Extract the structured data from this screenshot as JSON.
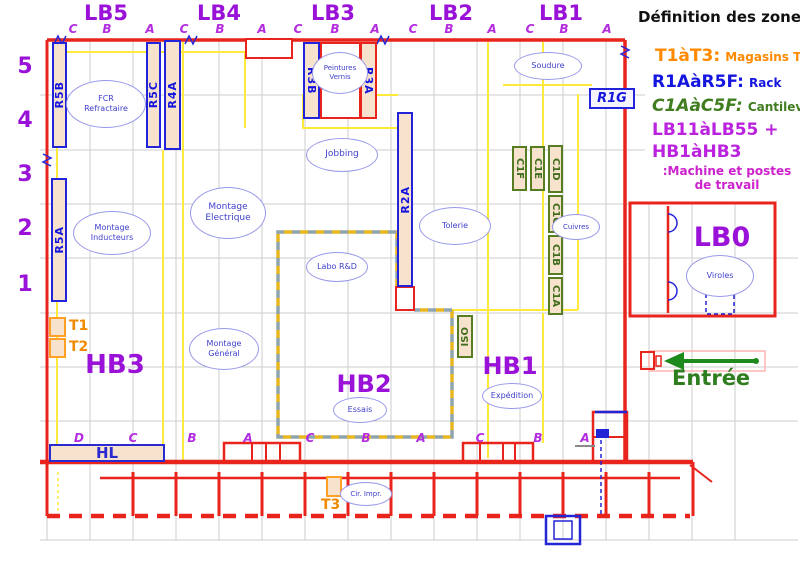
{
  "colors": {
    "wall_red": "#e8241c",
    "zone_purple": "#9a12d8",
    "rack_blue": "#1414dd",
    "cantilever_green": "#3f6d1c",
    "tour_orange": "#ff8a00",
    "machine_magenta": "#cc22cc",
    "entry_green": "#2e7d1e",
    "aisle_yellow": "#ffe93a",
    "rack_fill": "#f7e2cd",
    "cloud_blue": "#9898ea",
    "grid_gray": "#cdcdcd"
  },
  "top_zones": [
    {
      "label": "LB5",
      "letters": [
        "C",
        "B",
        "A"
      ]
    },
    {
      "label": "LB4",
      "letters": [
        "C",
        "B",
        "A"
      ]
    },
    {
      "label": "LB3",
      "letters": [
        "C",
        "B",
        "A"
      ]
    },
    {
      "label": "LB2",
      "letters": [
        "C",
        "B",
        "A"
      ]
    },
    {
      "label": "LB1",
      "letters": [
        "C",
        "B",
        "A"
      ]
    }
  ],
  "row_numbers": [
    "5",
    "4",
    "3",
    "2",
    "1"
  ],
  "bottom_letters": [
    "D",
    "C",
    "B",
    "A",
    "C",
    "B",
    "A",
    "C",
    "B",
    "A"
  ],
  "halls": {
    "hb3": "HB3",
    "hb2": "HB2",
    "hb1": "HB1",
    "lb0": "LB0",
    "hl": "HL"
  },
  "racks": {
    "r5b": "R5B",
    "r5c": "R5C",
    "r4a": "R4A",
    "r5a": "R5A",
    "r3b": "R3B",
    "r3a": "R3A",
    "r2a": "R2A",
    "r1g": "R1G"
  },
  "cantilevers": {
    "c1f": "C1F",
    "c1e": "C1E",
    "c1d": "C1D",
    "c1c": "C1C",
    "c1b": "C1B",
    "c1a": "C1A"
  },
  "iso_label": "ISO",
  "tours": {
    "t1": "T1",
    "t2": "T2",
    "t3": "T3"
  },
  "areas": {
    "fcr": "FCR\nRefractaire",
    "peintures": "Peintures\nVernis",
    "soudure": "Soudure",
    "jobbing": "Jobbing",
    "montage_electrique": "Montage\nElectrique",
    "montage_inducteurs": "Montage\nInducteurs",
    "tolerie": "Tolerie",
    "cuivres": "Cuivres",
    "labo_rd": "Labo R&D",
    "montage_general": "Montage\nGénéral",
    "essais": "Essais",
    "expedition": "Expédition",
    "viroles": "Viroles",
    "cir_impr": "Cir. Impr."
  },
  "legend": {
    "title": "Définition des zones:",
    "entries": [
      {
        "term": "T1àT3:",
        "desc": "Magasins Tour"
      },
      {
        "term": "R1AàR5F:",
        "desc": "Rack"
      },
      {
        "term": "C1AàC5F:",
        "desc": "Cantilever"
      },
      {
        "term": "LB11àLB55 +",
        "desc": ""
      },
      {
        "term": "HB1àHB3",
        "desc": ""
      }
    ],
    "note": ":Machine et postes\nde travail"
  },
  "entrance": {
    "label": "Entrée"
  }
}
